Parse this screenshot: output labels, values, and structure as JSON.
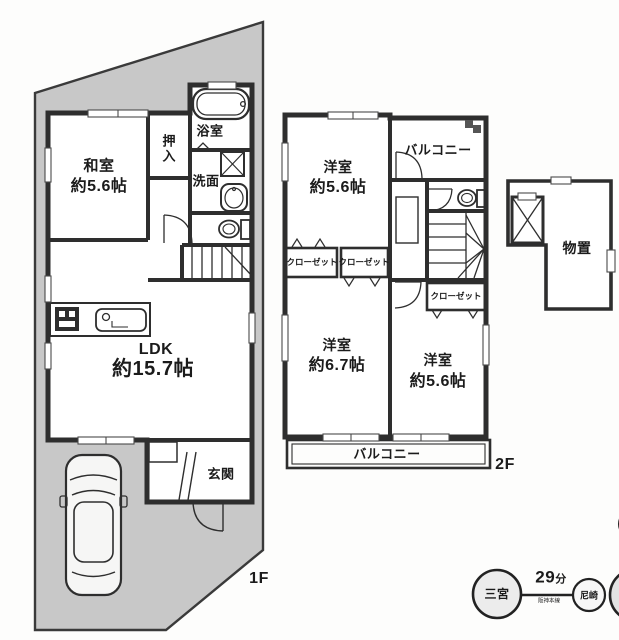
{
  "floor1": {
    "label": "1F",
    "washitsu_name": "和室",
    "washitsu_size": "約5.6帖",
    "oshiire": "押入",
    "bathroom": "浴室",
    "washroom": "洗面",
    "ldk_name": "LDK",
    "ldk_size": "約15.7帖",
    "genkan": "玄関"
  },
  "floor2": {
    "label": "2F",
    "bedroom1_name": "洋室",
    "bedroom1_size": "約5.6帖",
    "balcony_top": "バルコニー",
    "closet1": "クローゼット",
    "closet2": "クローゼット",
    "closet3": "クローゼット",
    "bedroom2_name": "洋室",
    "bedroom2_size": "約6.7帖",
    "bedroom3_name": "洋室",
    "bedroom3_size": "約5.6帖",
    "balcony_bottom": "バルコニー"
  },
  "storage": {
    "label": "物置"
  },
  "route": {
    "station_from": "三宮",
    "duration_value": "29",
    "duration_unit": "分",
    "line_name": "阪神本線",
    "station_next": "尼崎"
  },
  "colors": {
    "lot_fill": "#c8c8c8",
    "wall": "#2e2e2e",
    "text": "#1b1b1b"
  }
}
